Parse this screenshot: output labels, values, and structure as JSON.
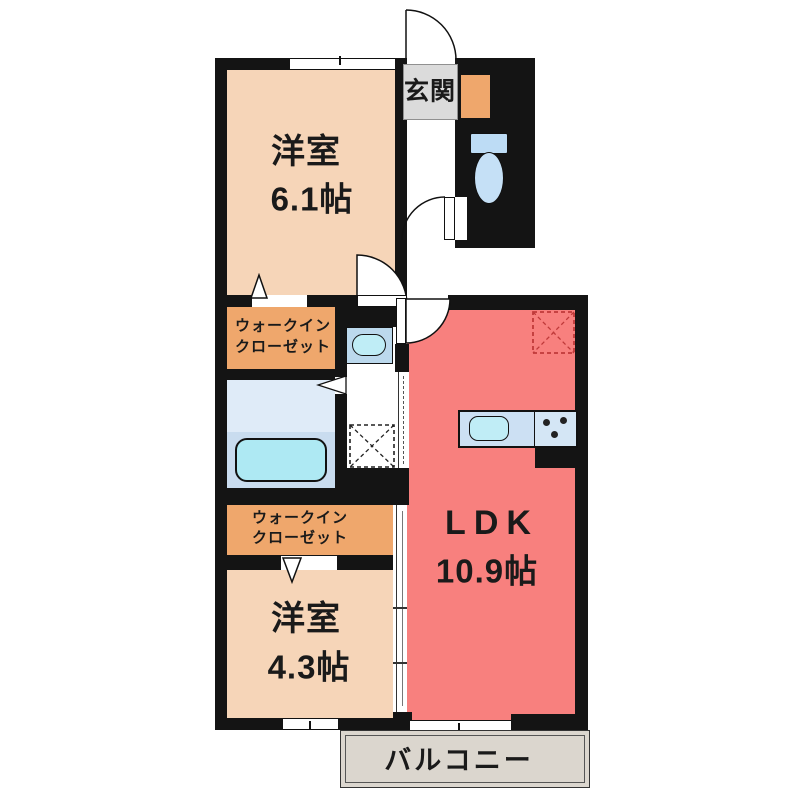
{
  "floorplan": {
    "rooms": {
      "bedroom_large": {
        "name": "洋室",
        "size": "6.1帖"
      },
      "bedroom_small": {
        "name": "洋室",
        "size": "4.3帖"
      },
      "ldk": {
        "name": "LDK",
        "size": "10.9帖"
      },
      "entrance": {
        "name": "玄関"
      },
      "walk_in_closet_upper": {
        "line1": "ウォークイン",
        "line2": "クローゼット"
      },
      "walk_in_closet_lower": {
        "line1": "ウォークイン",
        "line2": "クローゼット"
      },
      "balcony": {
        "name": "バルコニー"
      }
    },
    "colors": {
      "wall": "#141414",
      "bedroom_floor": "#F6D5B8",
      "closet_floor": "#EFA76C",
      "ldk_floor": "#F8807E",
      "wet_area": "#DCEAF9",
      "bathtub": "#AEE9F3",
      "balcony_floor": "#DBD6CE",
      "entrance_label_bg": "#DBDBDB",
      "refrigerator_dashed": "#C03A3A"
    }
  }
}
